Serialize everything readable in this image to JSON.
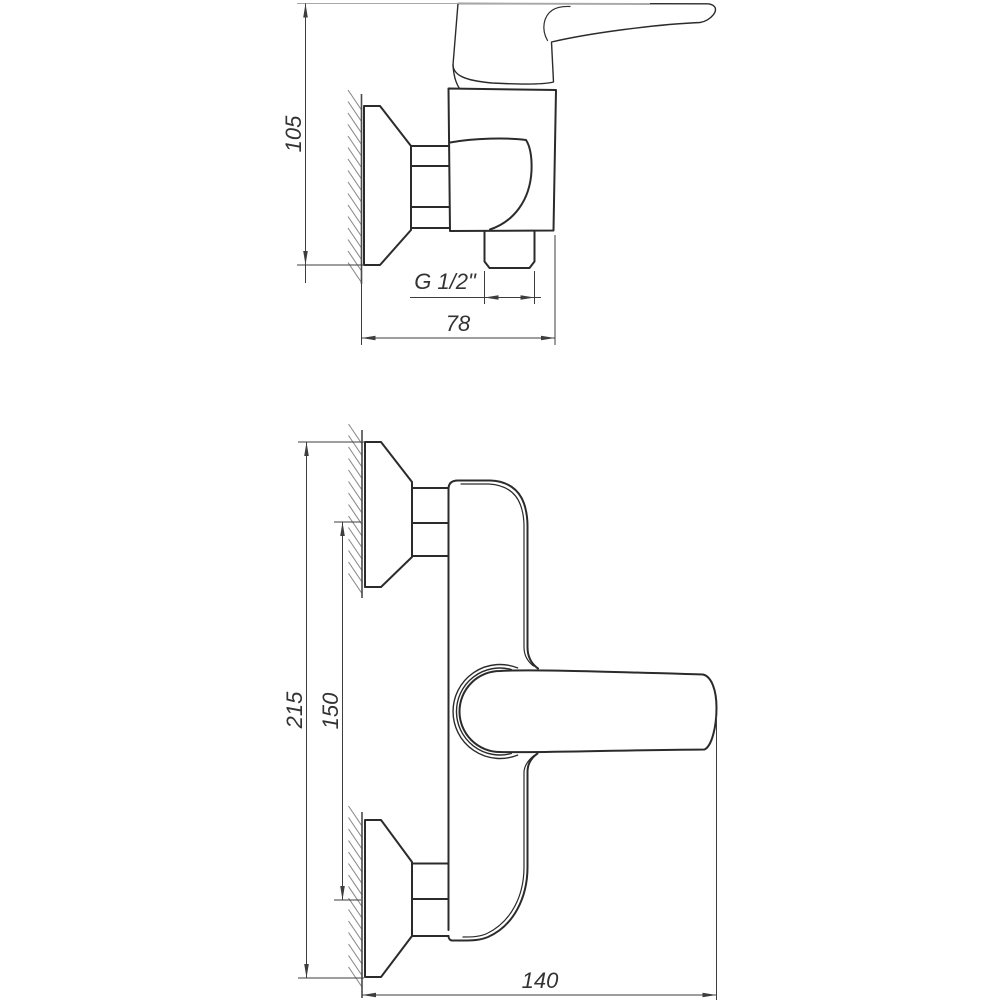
{
  "drawing": {
    "kind": "technical-drawing",
    "subject": "wall-mounted single-lever shower mixer, two orthographic views with dimensions",
    "background_color": "#ffffff",
    "ink_color": "#2b2b2b",
    "dimension_color": "#3d3d3d",
    "views": {
      "side_view": {
        "name": "side view (top drawing)",
        "labels": {
          "height": "105",
          "thread": "G 1/2\"",
          "depth": "78"
        }
      },
      "front_view": {
        "name": "front view (bottom drawing)",
        "labels": {
          "overall_height": "215",
          "pipe_centers": "150",
          "width": "140"
        }
      }
    }
  }
}
